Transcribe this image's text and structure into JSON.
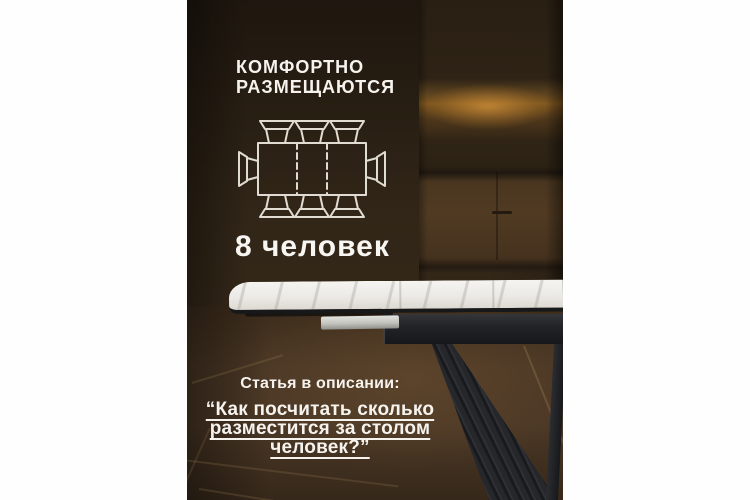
{
  "poster": {
    "headline_line1": "КОМФОРТНО",
    "headline_line2": "РАЗМЕЩАЮТСЯ",
    "capacity": "8 человек",
    "article_intro": "Статья в описании:",
    "quote_line1": "“Как посчитать сколько",
    "quote_line2": "разместится за столом",
    "quote_line3": "человек?”",
    "seating_icon": "table-top-view-with-8-chairs",
    "palette": {
      "text": "#f6f3ee",
      "wall_brown": "#32261a",
      "glow_amber": "#8a5e26",
      "cabinet_brown": "#4a3620",
      "floor_brown": "#4a3725",
      "tabletop_white": "#eceae6",
      "metal_black": "#1b1c20"
    }
  }
}
